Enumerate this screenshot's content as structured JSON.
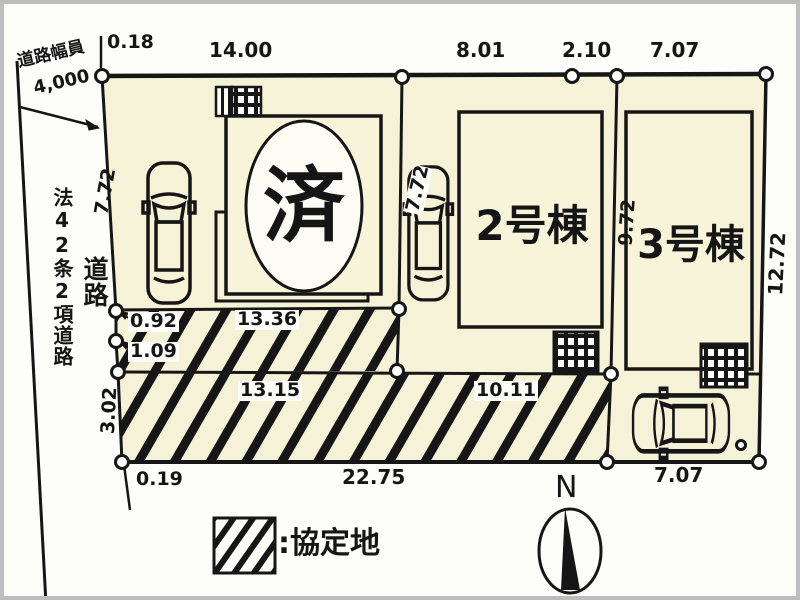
{
  "plan": {
    "road": {
      "width_label": "道路幅員",
      "width_value": "4,000",
      "law_label": "法42条2項道路",
      "road_label": "道路"
    },
    "buildings": {
      "b1_sticker": "済",
      "b2_label": "2号棟",
      "b3_label": "3号棟"
    },
    "dims": {
      "top_0_18": "0.18",
      "top_14_00": "14.00",
      "top_8_01": "8.01",
      "top_2_10": "2.10",
      "top_7_07": "7.07",
      "lot1_7_72": "7.72",
      "lot2_7_72": "7.72",
      "b3_9_72": "9.72",
      "right_12_72": "12.72",
      "left_0_92": "0.92",
      "left_1_09": "1.09",
      "left_3_02": "3.02",
      "strip_13_36": "13.36",
      "strip_13_15": "13.15",
      "strip_10_11": "10.11",
      "bottom_22_75": "22.75",
      "bottom_0_19": "0.19",
      "bottom_7_07": "7.07"
    },
    "legend": {
      "label": ":協定地"
    },
    "compass": {
      "north_label": "N"
    },
    "colors": {
      "lot_fill": "#f6f2d8",
      "building_fill": "#f8f4da",
      "line": "#161616",
      "paper": "#fdfdfa"
    }
  }
}
